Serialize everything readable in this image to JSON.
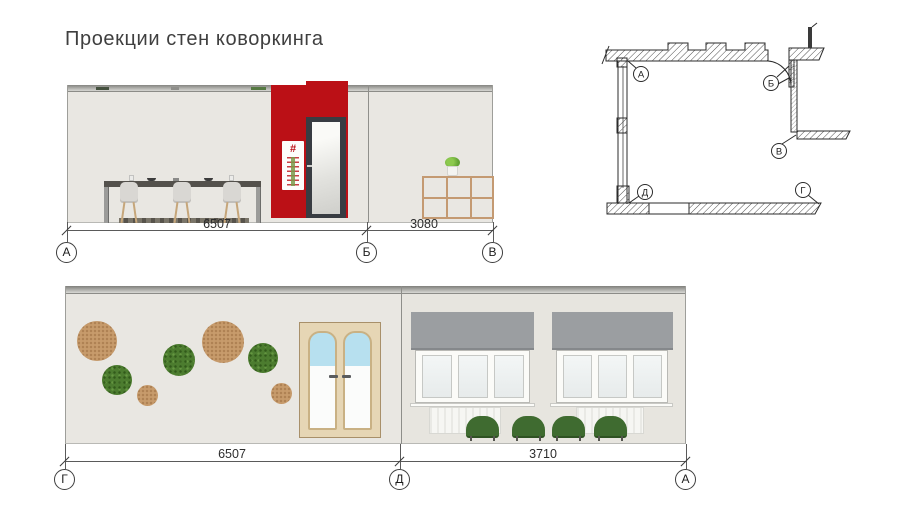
{
  "title": "Проекции стен коворкинга",
  "top_elevation": {
    "dimensions": [
      "6507",
      "3080"
    ],
    "markers": [
      "А",
      "Б",
      "В"
    ],
    "poster_symbol": "#"
  },
  "bottom_elevation": {
    "dimensions": [
      "6507",
      "3710"
    ],
    "markers": [
      "Г",
      "Д",
      "А"
    ]
  },
  "floor_plan": {
    "markers": {
      "a": "А",
      "b": "Б",
      "v": "В",
      "g": "Г",
      "d": "Д"
    }
  },
  "colors": {
    "accent_red": "#bb1016",
    "wall_fill": "#e9e7e2",
    "cork": "#c79b6c",
    "moss": "#4c7c2f",
    "blind_gray": "#9b9ea1",
    "chair_green": "#3f6b30",
    "door_wood": "#e6d6b5",
    "glass_blue": "#b7e0ef"
  }
}
